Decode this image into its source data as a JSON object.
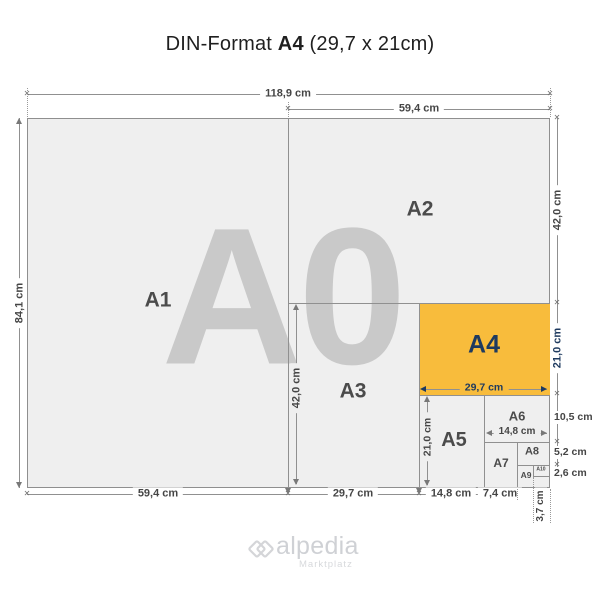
{
  "title": {
    "prefix": "DIN-Format",
    "format": "A4",
    "suffix": "(29,7 x 21cm)"
  },
  "watermark": "A0",
  "labels": {
    "a1": "A1",
    "a2": "A2",
    "a3": "A3",
    "a4": "A4",
    "a5": "A5",
    "a6": "A6",
    "a7": "A7",
    "a8": "A8",
    "a9": "A9",
    "a10": "A10"
  },
  "dims": {
    "total_width": "118,9 cm",
    "half_width_top": "59,4 cm",
    "total_height": "84,1 cm",
    "a2_height": "42,0 cm",
    "a3_height": "42,0 cm",
    "a4_width": "29,7 cm",
    "a4_height": "21,0 cm",
    "a5_height": "21,0 cm",
    "a6_width": "14,8 cm",
    "a6_height": "10,5 cm",
    "a8_height": "5,2 cm",
    "a10_height": "2,6 cm",
    "a1_width": "59,4 cm",
    "a3_width": "29,7 cm",
    "a5_width": "14,8 cm",
    "a7_width": "7,4 cm",
    "a10_width": "3,7 cm"
  },
  "icons": {
    "tick": "✕"
  },
  "logo": {
    "name": "alpedia",
    "tagline": "Marktplatz"
  },
  "colors": {
    "highlight": "#F8BC3C",
    "navy": "#1E3A5F",
    "sheet_fill": "#EFEFEF",
    "line": "#8F8F8F",
    "watermark": "#C9C9C9"
  }
}
